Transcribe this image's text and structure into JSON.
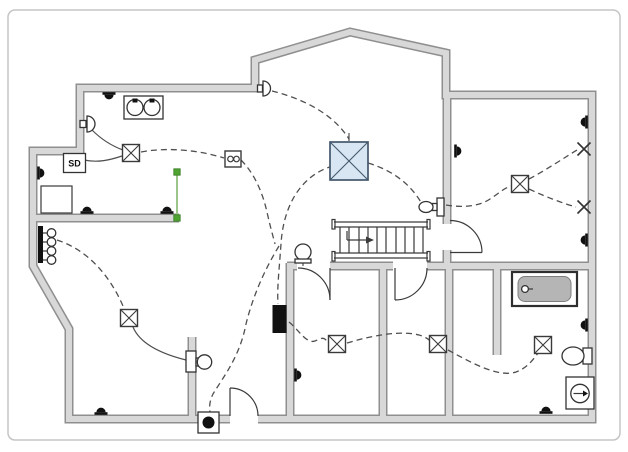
{
  "document": {
    "type": "Electrical wiring floor plan",
    "background": "#ffffff",
    "frame_color": "#c5c5c5"
  },
  "palette": {
    "wall_face": "#d8d8d8",
    "wall_edge": "#8f8f8f",
    "ink": "#3a3a3a",
    "wire": "#4f4f4f",
    "ceiling_fan_fill": "#d8e5f2",
    "ceiling_fan_edge": "#44586c",
    "selection_green": "#4fa331",
    "panel": "#111111",
    "tub_fill": "#b5b5b5"
  },
  "labels": {
    "smoke_detector": "SD"
  },
  "symbols": {
    "receptacle_outlets": [
      {
        "x": 109,
        "y": 96,
        "rot": 180
      },
      {
        "x": 41,
        "y": 173,
        "rot": 90
      },
      {
        "x": 87,
        "y": 210,
        "rot": 0
      },
      {
        "x": 167,
        "y": 210,
        "rot": 0
      },
      {
        "x": 101,
        "y": 411,
        "rot": 0
      },
      {
        "x": 298,
        "y": 375,
        "rot": 90
      },
      {
        "x": 458,
        "y": 151,
        "rot": 90
      },
      {
        "x": 584,
        "y": 122,
        "rot": 270
      },
      {
        "x": 584,
        "y": 240,
        "rot": 270
      },
      {
        "x": 584,
        "y": 325,
        "rot": 270
      },
      {
        "x": 546,
        "y": 410,
        "rot": 0
      }
    ],
    "junction_boxes": [
      {
        "x": 131,
        "y": 153,
        "rot": 0
      },
      {
        "x": 520,
        "y": 184,
        "rot": 0
      },
      {
        "x": 129,
        "y": 318,
        "rot": 0
      },
      {
        "x": 337,
        "y": 344,
        "rot": 0
      },
      {
        "x": 438,
        "y": 344,
        "rot": 0
      },
      {
        "x": 543,
        "y": 345,
        "rot": 0
      }
    ],
    "special_outlets_x": [
      {
        "x": 584,
        "y": 149,
        "rot": 0
      },
      {
        "x": 584,
        "y": 207,
        "rot": 0
      }
    ]
  },
  "fixtures_inventory": [
    "smoke-detector",
    "ceiling-fan-box",
    "double-sink-unit",
    "closet-box",
    "multi-outlet-strip",
    "wall-light-left",
    "wall-light-bay",
    "wall-sconce-stairs",
    "wall-lamp-stub",
    "hall-wall-light",
    "electrical-panel",
    "doorbell-box",
    "bathtub",
    "toilet",
    "exhaust-fan",
    "staircase",
    "duplex-outlet-box"
  ]
}
